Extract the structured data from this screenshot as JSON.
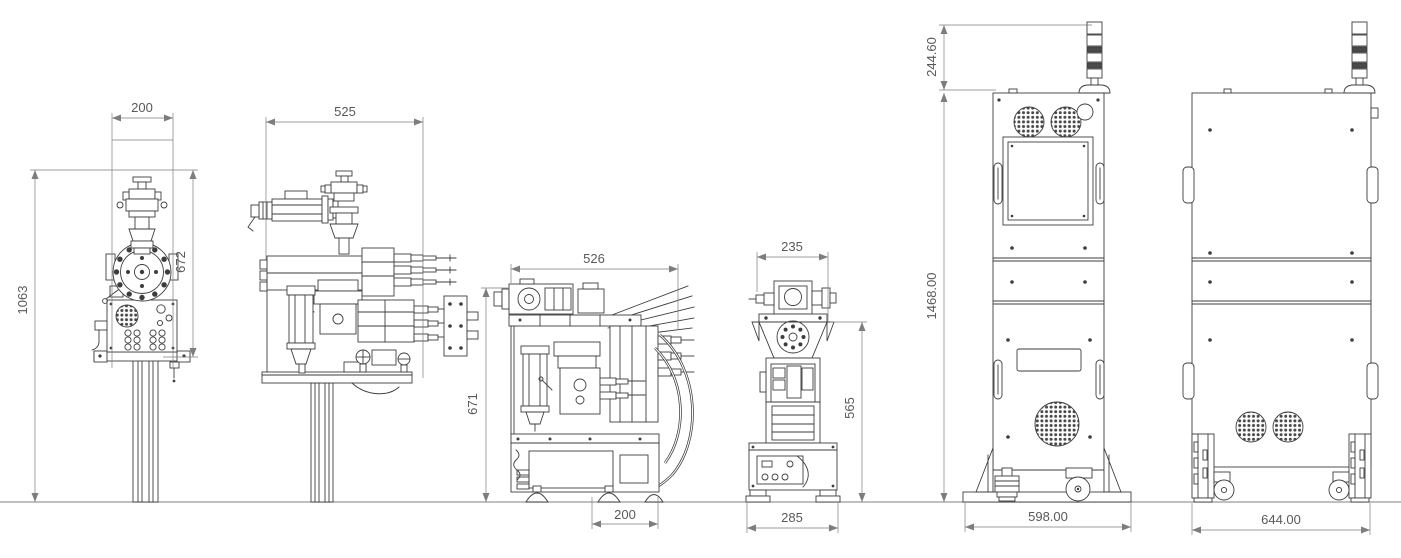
{
  "drawing": {
    "type": "engineering-dimension-drawing",
    "units": "mm",
    "colors": {
      "line": "#3d3d3d",
      "dimension": "#7d7d7d",
      "text": "#595959",
      "ground": "#9b9b9b",
      "background": "#ffffff"
    },
    "views": [
      {
        "label": "pump-front-view",
        "dims": {
          "top": "200",
          "left": "1063",
          "right": "672"
        }
      },
      {
        "label": "pump-side-view",
        "dims": {
          "top": "525"
        }
      },
      {
        "label": "doser-side-view",
        "dims": {
          "top": "526",
          "left": "671",
          "bottom": "200"
        }
      },
      {
        "label": "doser-front-view",
        "dims": {
          "top": "235",
          "right": "565",
          "bottom": "285"
        }
      },
      {
        "label": "cabinet-front-view",
        "dims": {
          "beacon": "244.60",
          "left": "1468.00",
          "bottom": "598.00"
        }
      },
      {
        "label": "cabinet-side-view",
        "dims": {
          "bottom": "644.00"
        }
      }
    ]
  }
}
